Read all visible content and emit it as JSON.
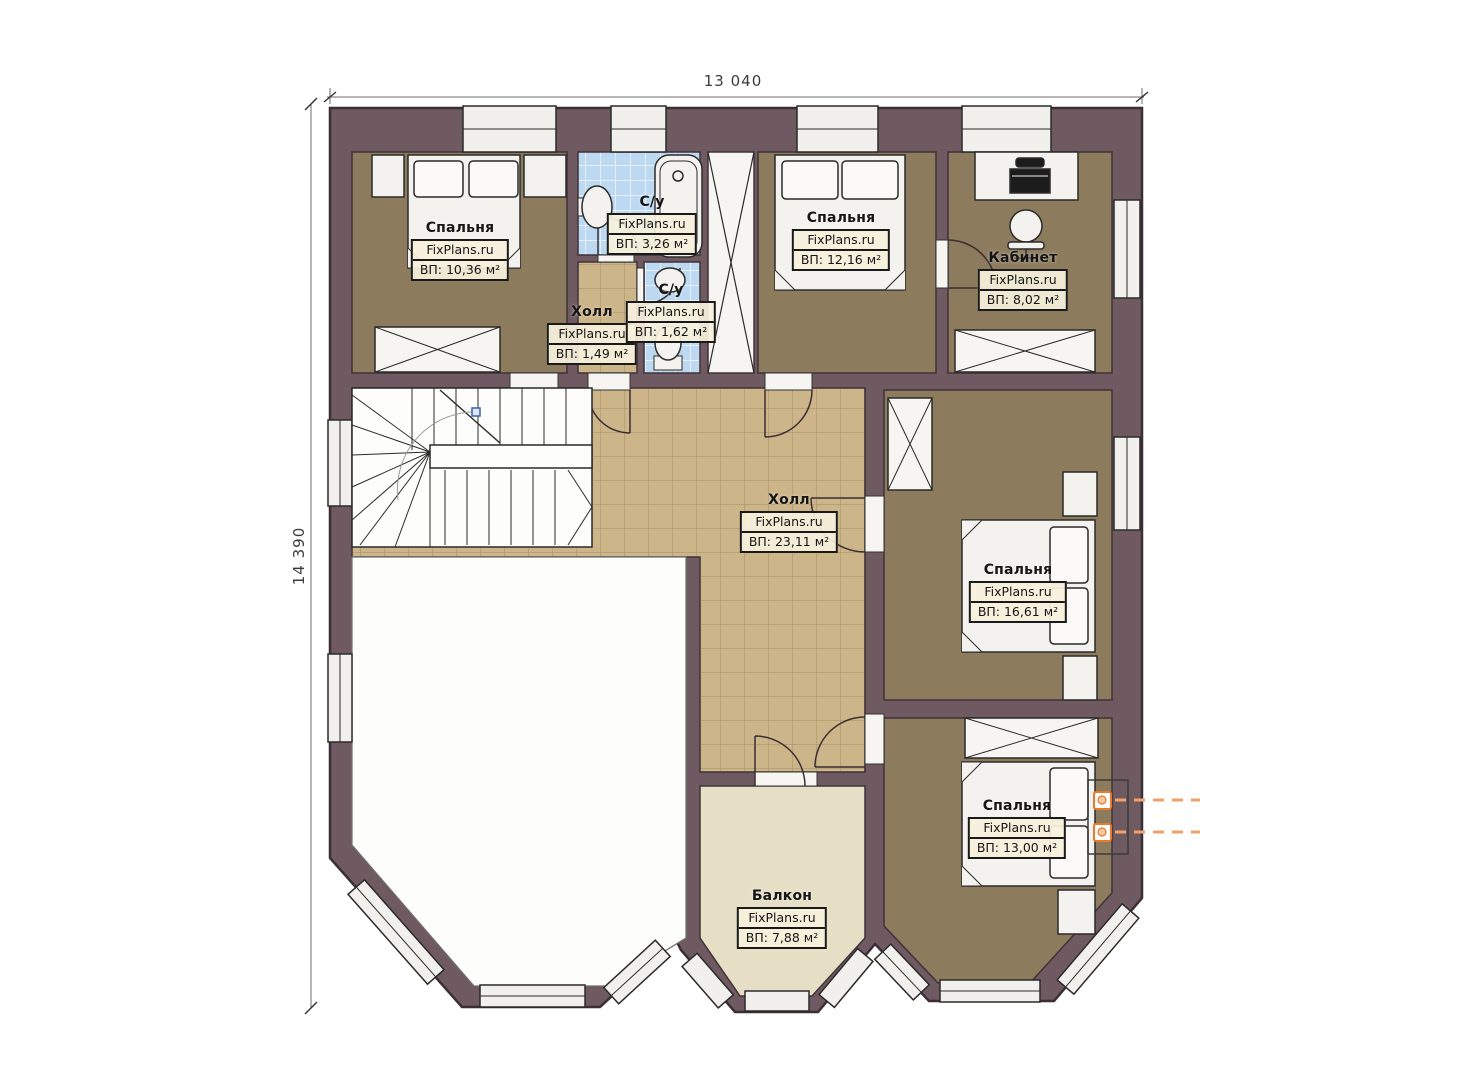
{
  "plan": {
    "dimension_top": "13 040",
    "dimension_left": "14 390",
    "watermark": "FixPlans.ru",
    "rooms": [
      {
        "key": "bedroom-1",
        "name": "Спальня",
        "area": "ВП: 10,36 м²"
      },
      {
        "key": "bathroom-1",
        "name": "С/у",
        "area": "ВП: 3,26 м²"
      },
      {
        "key": "hall-small",
        "name": "Холл",
        "area": "ВП: 1,49 м²"
      },
      {
        "key": "bathroom-2",
        "name": "С/у",
        "area": "ВП: 1,62 м²"
      },
      {
        "key": "bedroom-2",
        "name": "Спальня",
        "area": "ВП: 12,16 м²"
      },
      {
        "key": "study",
        "name": "Кабинет",
        "area": "ВП: 8,02 м²"
      },
      {
        "key": "hall-main",
        "name": "Холл",
        "area": "ВП: 23,11 м²"
      },
      {
        "key": "bedroom-3",
        "name": "Спальня",
        "area": "ВП: 16,61 м²"
      },
      {
        "key": "bedroom-4",
        "name": "Спальня",
        "area": "ВП: 13,00 м²"
      },
      {
        "key": "balcony",
        "name": "Балкон",
        "area": "ВП: 7,88 м²"
      }
    ],
    "colors": {
      "wall": "#6f5a62",
      "bedroom_floor": "#8d7b5d",
      "hall_tile": "#cdb58a",
      "bath_tile": "#bdd9f2",
      "balcony_floor": "#e7dec6",
      "radiator_accent": "#e87a28"
    }
  }
}
